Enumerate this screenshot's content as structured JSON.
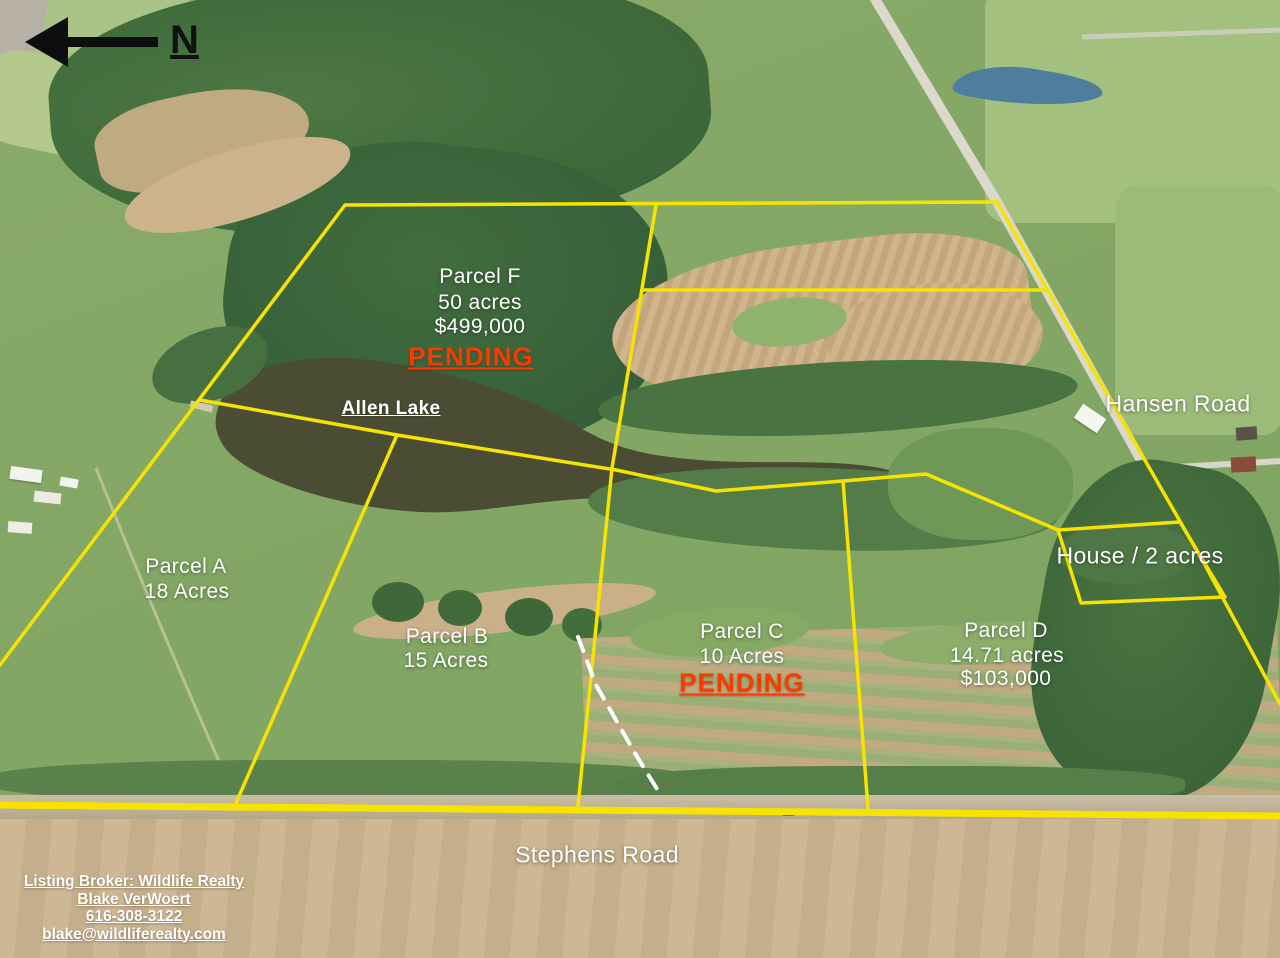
{
  "compass": {
    "label": "N"
  },
  "parcels": [
    {
      "id": "F",
      "name": "Parcel F",
      "size": "50 acres",
      "price": "$499,000",
      "status": "PENDING"
    },
    {
      "id": "A",
      "name": "Parcel A",
      "size": "18 Acres"
    },
    {
      "id": "B",
      "name": "Parcel B",
      "size": "15 Acres"
    },
    {
      "id": "C",
      "name": "Parcel C",
      "size": "10 Acres",
      "status": "PENDING"
    },
    {
      "id": "D",
      "name": "Parcel D",
      "size": "14.71 acres",
      "price": "$103,000"
    }
  ],
  "features": {
    "lake_label": "Allen Lake",
    "house_label": "House / 2 acres"
  },
  "roads": [
    {
      "name": "Hansen Road"
    },
    {
      "name": "Stephens Road"
    }
  ],
  "broker": {
    "line1": "Listing Broker: Wildlife Realty",
    "line2": "Blake VerWoert",
    "phone": "616-308-3122",
    "email": "blake@wildliferealty.com"
  },
  "colors": {
    "boundary_yellow": "#F6E400",
    "pending_red": "#FB3A00",
    "label_white": "#FFFFFF",
    "lake_water": "#4A4D33",
    "pond_water": "#4F7D9E"
  }
}
